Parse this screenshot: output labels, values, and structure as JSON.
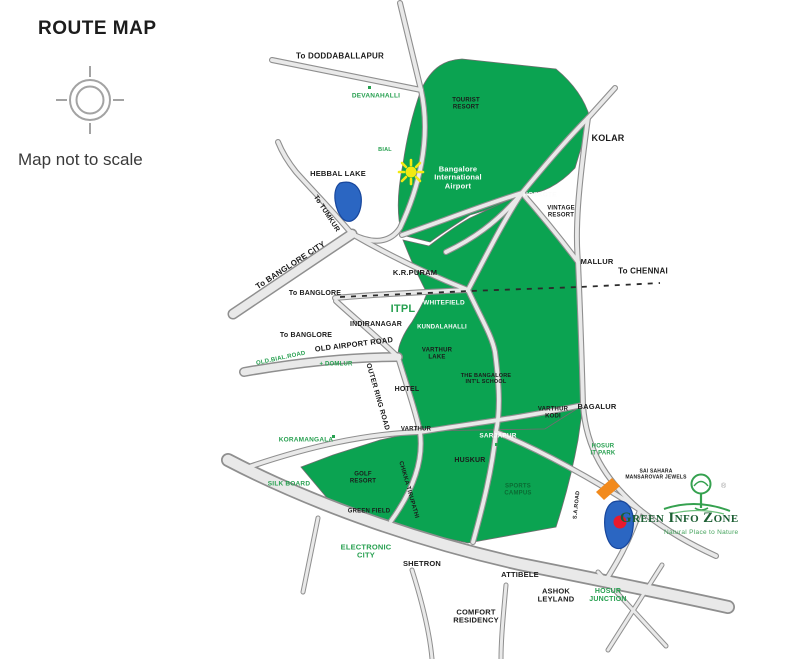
{
  "header": {
    "title": "ROUTE MAP",
    "note": "Map not to scale"
  },
  "logo": {
    "title": "Green Info Zone",
    "tagline": "Natural Place to Nature",
    "reg": "®"
  },
  "colors": {
    "map_green": "#0ba351",
    "road_fill": "#e8e8e8",
    "road_casing": "#8f8f8f",
    "lake_blue": "#2b66c2",
    "sun_yellow": "#f2ea12",
    "marker_orange": "#f28a1c",
    "location_red": "#e81a2b",
    "label_green": "#27a050",
    "logo_green": "#1c5e33"
  },
  "map": {
    "labels": [
      {
        "id": "doddaballapur",
        "text": "To DODDABALLAPUR",
        "x": 340,
        "y": 57,
        "fs": 8,
        "cls": "black"
      },
      {
        "id": "devanahalli",
        "text": "DEVANAHALLI",
        "x": 376,
        "y": 96,
        "fs": 6.5,
        "cls": "green"
      },
      {
        "id": "tourist-resort",
        "text": "TOURIST\nRESORT",
        "x": 466,
        "y": 104,
        "fs": 6,
        "cls": "black"
      },
      {
        "id": "intl-airport",
        "text": "Bangalore\nInternational\nAirport",
        "x": 458,
        "y": 178,
        "fs": 7.5,
        "cls": "white"
      },
      {
        "id": "hoskote",
        "text": "HOSKOTE",
        "x": 540,
        "y": 195,
        "fs": 6.5,
        "cls": "white"
      },
      {
        "id": "vintage-resort",
        "text": "VINTAGE\nRESORT",
        "x": 561,
        "y": 212,
        "fs": 6,
        "cls": "black"
      },
      {
        "id": "kolar",
        "text": "KOLAR",
        "x": 608,
        "y": 138,
        "fs": 9,
        "cls": "black"
      },
      {
        "id": "mallur",
        "text": "MALLUR",
        "x": 597,
        "y": 262,
        "fs": 7.5,
        "cls": "black"
      },
      {
        "id": "to-chennai",
        "text": "To CHENNAI",
        "x": 643,
        "y": 272,
        "fs": 8,
        "cls": "black"
      },
      {
        "id": "hebbal-lake",
        "text": "HEBBAL LAKE",
        "x": 338,
        "y": 174,
        "fs": 7.5,
        "cls": "black"
      },
      {
        "id": "to-tumkur",
        "text": "To TUMKUR",
        "x": 326,
        "y": 214,
        "fs": 7,
        "cls": "black",
        "rot": 57
      },
      {
        "id": "to-banglore-city",
        "text": "To BANGLORE CITY",
        "x": 291,
        "y": 266,
        "fs": 8,
        "cls": "black",
        "rot": -33
      },
      {
        "id": "kr-puram",
        "text": "K.R.PURAM",
        "x": 415,
        "y": 273,
        "fs": 7.5,
        "cls": "black"
      },
      {
        "id": "to-banglore-omr",
        "text": "To BANGLORE",
        "x": 315,
        "y": 294,
        "fs": 7,
        "cls": "black"
      },
      {
        "id": "itpl",
        "text": "ITPL",
        "x": 403,
        "y": 309,
        "fs": 11,
        "cls": "green"
      },
      {
        "id": "whitefield",
        "text": "WHITEFIELD",
        "x": 444,
        "y": 303,
        "fs": 6.5,
        "cls": "white"
      },
      {
        "id": "kundalahalli",
        "text": "KUNDALAHALLI",
        "x": 442,
        "y": 328,
        "fs": 6,
        "cls": "white"
      },
      {
        "id": "indiranagar",
        "text": "INDIRANAGAR",
        "x": 376,
        "y": 325,
        "fs": 7,
        "cls": "black"
      },
      {
        "id": "to-banglore-oar",
        "text": "To BANGLORE",
        "x": 306,
        "y": 336,
        "fs": 7,
        "cls": "black"
      },
      {
        "id": "old-airport-road",
        "text": "OLD AIRPORT ROAD",
        "x": 354,
        "y": 345,
        "fs": 7.5,
        "cls": "black",
        "rot": -7
      },
      {
        "id": "old-bial-road",
        "text": "OLD.BIAL.ROAD",
        "x": 281,
        "y": 359,
        "fs": 6,
        "cls": "green",
        "rot": -12
      },
      {
        "id": "domlur",
        "text": "+ DOMLUR",
        "x": 336,
        "y": 365,
        "fs": 6,
        "cls": "green"
      },
      {
        "id": "varthur-lake",
        "text": "VARTHUR\nLAKE",
        "x": 437,
        "y": 354,
        "fs": 6,
        "cls": "black"
      },
      {
        "id": "outer-ring-road",
        "text": "OUTER RING ROAD",
        "x": 377,
        "y": 397,
        "fs": 7,
        "cls": "black",
        "rot": 74
      },
      {
        "id": "hotel",
        "text": "HOTEL",
        "x": 407,
        "y": 390,
        "fs": 7,
        "cls": "black"
      },
      {
        "id": "intl-school",
        "text": "THE BANGALORE\nINT'L SCHOOL",
        "x": 486,
        "y": 379,
        "fs": 5.5,
        "cls": "black"
      },
      {
        "id": "varthur-kodi",
        "text": "VARTHUR\nKODI",
        "x": 553,
        "y": 413,
        "fs": 6,
        "cls": "black"
      },
      {
        "id": "bagalur",
        "text": "BAGALUR",
        "x": 597,
        "y": 407,
        "fs": 7.5,
        "cls": "black"
      },
      {
        "id": "varthur",
        "text": "VARTHUR",
        "x": 416,
        "y": 430,
        "fs": 6,
        "cls": "black"
      },
      {
        "id": "sarjapur",
        "text": "SARJAPUR",
        "x": 498,
        "y": 436,
        "fs": 6.5,
        "cls": "white"
      },
      {
        "id": "huskur",
        "text": "HUSKUR",
        "x": 470,
        "y": 461,
        "fs": 7,
        "cls": "black"
      },
      {
        "id": "sports-campus",
        "text": "SPORTS\nCAMPUS",
        "x": 518,
        "y": 490,
        "fs": 6,
        "cls": "dgreen"
      },
      {
        "id": "koramangala",
        "text": "KORAMANGALA",
        "x": 306,
        "y": 440,
        "fs": 6.5,
        "cls": "green"
      },
      {
        "id": "silk-board",
        "text": "SILK BOARD",
        "x": 289,
        "y": 484,
        "fs": 6.5,
        "cls": "green"
      },
      {
        "id": "golf-resort",
        "text": "GOLF\nRESORT",
        "x": 363,
        "y": 478,
        "fs": 6,
        "cls": "black"
      },
      {
        "id": "chikka-tirupathi",
        "text": "CHIKKA TIRUPATHI",
        "x": 408,
        "y": 490,
        "fs": 6,
        "cls": "black",
        "rot": 74
      },
      {
        "id": "green-field",
        "text": "GREEN FIELD",
        "x": 369,
        "y": 512,
        "fs": 6,
        "cls": "black"
      },
      {
        "id": "electronic-city",
        "text": "ELECTRONIC\nCITY",
        "x": 366,
        "y": 552,
        "fs": 7.5,
        "cls": "green"
      },
      {
        "id": "shetron",
        "text": "SHETRON",
        "x": 422,
        "y": 564,
        "fs": 7.5,
        "cls": "black"
      },
      {
        "id": "attibele",
        "text": "ATTIBELE",
        "x": 520,
        "y": 575,
        "fs": 7.5,
        "cls": "black"
      },
      {
        "id": "ashok-leyland",
        "text": "ASHOK\nLEYLAND",
        "x": 556,
        "y": 596,
        "fs": 7.5,
        "cls": "black"
      },
      {
        "id": "comfort-residency",
        "text": "COMFORT\nRESIDENCY",
        "x": 476,
        "y": 617,
        "fs": 7.5,
        "cls": "black"
      },
      {
        "id": "hosur-junction",
        "text": "HOSUR\nJUNCTION",
        "x": 608,
        "y": 596,
        "fs": 7,
        "cls": "green"
      },
      {
        "id": "hosur-it-park",
        "text": "HOSUR\nIT PARK",
        "x": 603,
        "y": 450,
        "fs": 6,
        "cls": "green"
      },
      {
        "id": "sai-sahara",
        "text": "SAI SAHARA\nMANSAROVAR JEWELS",
        "x": 656,
        "y": 475,
        "fs": 5,
        "cls": "black"
      },
      {
        "id": "bial",
        "text": "BIAL",
        "x": 385,
        "y": 150,
        "fs": 5.5,
        "cls": "green"
      },
      {
        "id": "sa-road",
        "text": "S.A.ROAD",
        "x": 577,
        "y": 505,
        "fs": 5.5,
        "cls": "black",
        "rot": -84
      }
    ]
  }
}
